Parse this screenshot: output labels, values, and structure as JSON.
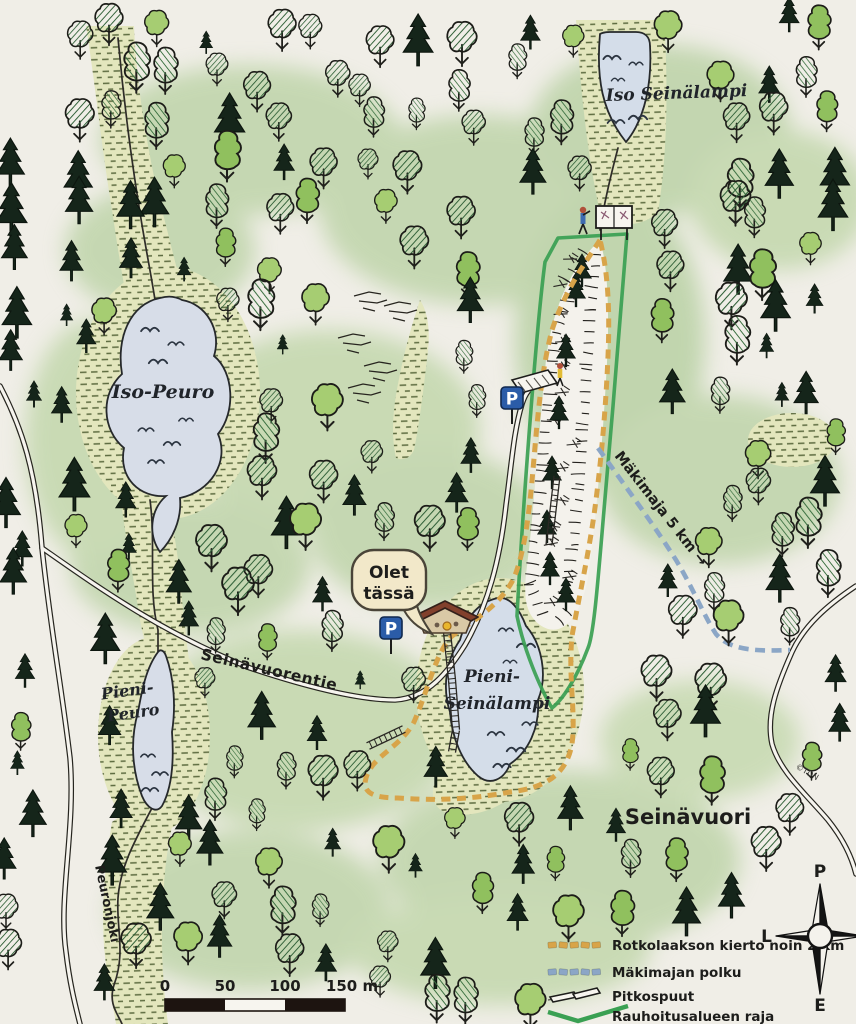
{
  "map": {
    "labels": {
      "iso_seinalampi": "Iso Seinälampi",
      "iso_peuro": "Iso-Peuro",
      "pieni_peuro_line1": "Pieni-",
      "pieni_peuro_line2": "Peuro",
      "pieni_seinalampi_line1": "Pieni-",
      "pieni_seinalampi_line2": "Seinälampi",
      "peuronjoki": "Peuronjoki",
      "seinavuorentie": "Seinävuorentie",
      "seinavuori": "Seinävuori",
      "makimaja": "Mäkimaja 5 km →",
      "credit": "©TDN"
    },
    "you_are_here": {
      "line1": "Olet",
      "line2": "tässä"
    },
    "parking_letter": "P",
    "colors": {
      "trail_orange": "#d8a449",
      "trail_blue": "#8ba6c6",
      "boundary_green": "#3aa053",
      "water_fill": "#d4dde9",
      "marsh_fill": "#e3e6bd",
      "paper": "#f0eee7",
      "parking_blue": "#2b5ca8"
    }
  },
  "legend": {
    "items": [
      {
        "label": "Rotkolaakson kierto noin 2 km",
        "type": "dashed",
        "color": "#d8a449"
      },
      {
        "label": "Mäkimajan polku",
        "type": "dashed",
        "color": "#8ba6c6"
      },
      {
        "label": "Pitkospuut",
        "type": "boardwalk",
        "color": "#f6f4ee"
      },
      {
        "label": "Rauhoitusalueen raja",
        "type": "line",
        "color": "#3aa053"
      }
    ]
  },
  "scale_bar": {
    "ticks": [
      "0",
      "50",
      "100",
      "150 m"
    ]
  },
  "compass": {
    "north": "P",
    "west": "L",
    "south": "E",
    "east": "I"
  }
}
